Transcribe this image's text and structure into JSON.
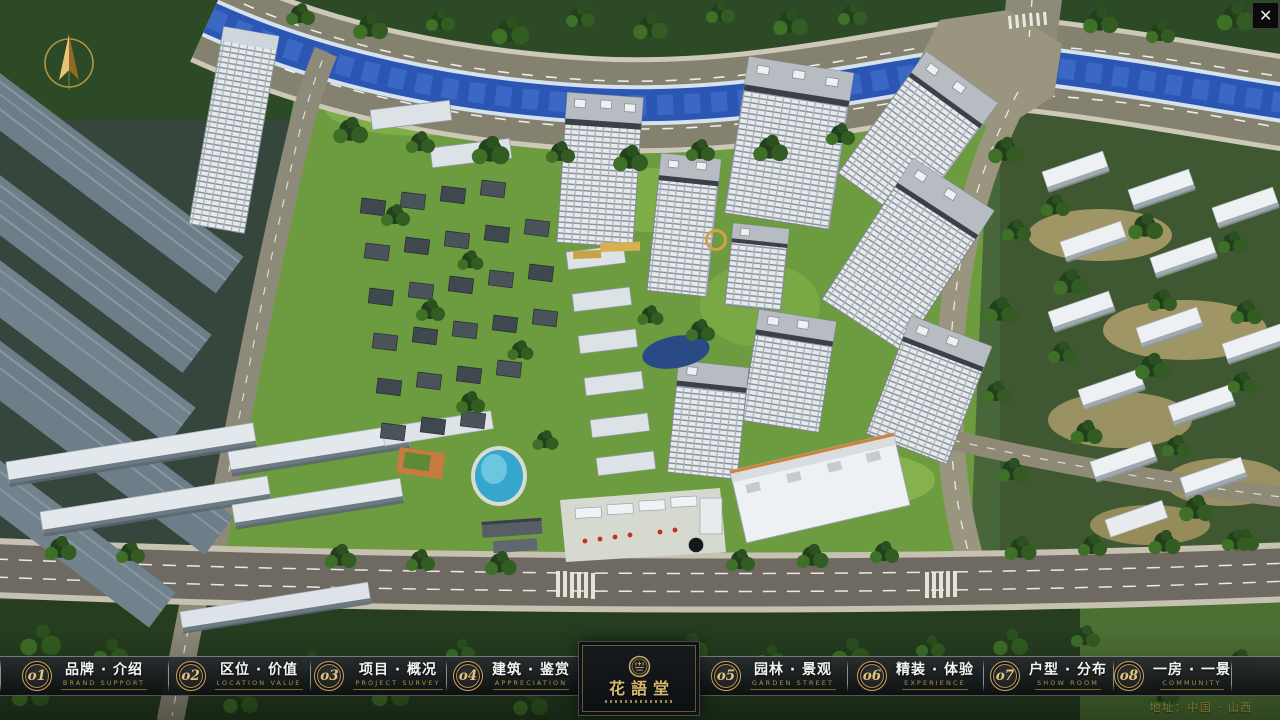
{
  "window": {
    "close_label": "✕"
  },
  "compass": {
    "icon": "north-arrow-icon"
  },
  "nav": {
    "items": [
      {
        "num": "o1",
        "zh": "品牌 · 介绍",
        "en": "BRAND SUPPORT"
      },
      {
        "num": "o2",
        "zh": "区位 · 价值",
        "en": "LOCATION VALUE"
      },
      {
        "num": "o3",
        "zh": "项目 · 概况",
        "en": "PROJECT SURVEY"
      },
      {
        "num": "o4",
        "zh": "建筑 · 鉴赏",
        "en": "APPRECIATION"
      },
      {
        "num": "o5",
        "zh": "园林 · 景观",
        "en": "GARDEN STREET"
      },
      {
        "num": "o6",
        "zh": "精装 · 体验",
        "en": "EXPERIENCE"
      },
      {
        "num": "o7",
        "zh": "户型 · 分布",
        "en": "SHOW ROOM"
      },
      {
        "num": "o8",
        "zh": "一房 · 一景",
        "en": "COMMUNITY"
      }
    ]
  },
  "logo": {
    "title": "花語堂",
    "seal_icon": "hua-yu-tang-seal-icon"
  },
  "footer": {
    "address": "地址：中国 · 山西"
  },
  "colors": {
    "accent_gold": "#C9A75D",
    "nav_background": "rgba(12,14,16,0.92)",
    "river_blue": "#2C56B4",
    "lawn_green": "#6D9B3F",
    "road_gray": "#85816F"
  }
}
